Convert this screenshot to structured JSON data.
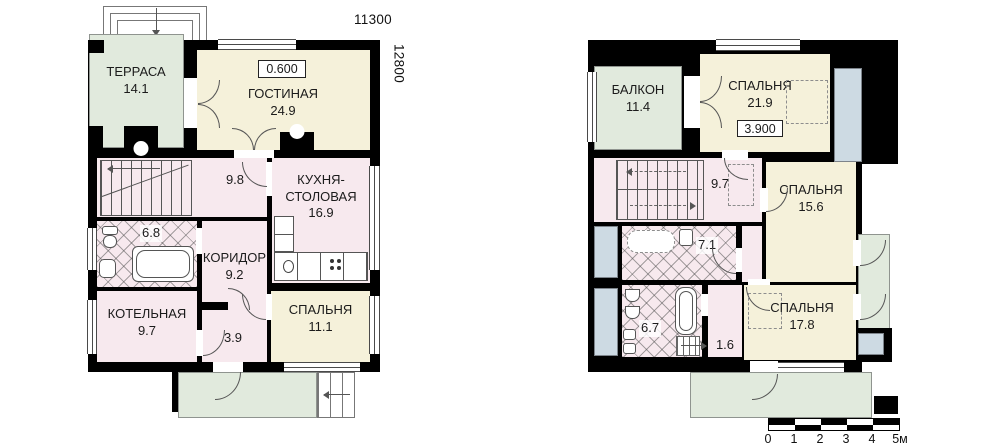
{
  "floor1": {
    "dimensions": {
      "width_mm": "11300",
      "height_mm": "12800"
    },
    "level_mark": "0.600",
    "rooms": {
      "terrace": {
        "name": "ТЕРРАСА",
        "area": "14.1"
      },
      "living": {
        "name": "ГОСТИНАЯ",
        "area": "24.9"
      },
      "hall": {
        "area": "9.8"
      },
      "kitchen": {
        "name": "КУХНЯ-СТОЛОВАЯ",
        "area": "16.9"
      },
      "bathroom": {
        "area": "6.8"
      },
      "corridor": {
        "name": "КОРИДОР",
        "area": "9.2"
      },
      "boiler": {
        "name": "КОТЕЛЬНАЯ",
        "area": "9.7"
      },
      "hall2": {
        "area": "3.9"
      },
      "bedroom": {
        "name": "СПАЛЬНЯ",
        "area": "11.1"
      }
    }
  },
  "floor2": {
    "level_mark": "3.900",
    "rooms": {
      "balcony": {
        "name": "БАЛКОН",
        "area": "11.4"
      },
      "bedroom1": {
        "name": "СПАЛЬНЯ",
        "area": "21.9"
      },
      "hall": {
        "area": "9.7"
      },
      "bedroom2": {
        "name": "СПАЛЬНЯ",
        "area": "15.6"
      },
      "bathroom1": {
        "area": "7.1"
      },
      "bathroom2": {
        "area": "6.7"
      },
      "hall2": {
        "area": "1.6"
      },
      "bedroom3": {
        "name": "СПАЛЬНЯ",
        "area": "17.8"
      }
    }
  },
  "scale_bar": {
    "unit_labels": [
      "0",
      "1",
      "2",
      "3",
      "4",
      "5м"
    ]
  },
  "colors": {
    "wall": "#000000",
    "room_living": "#f5f1da",
    "room_service": "#f7e9ee",
    "outdoor": "#e1eadd",
    "glazing": "#cddae3"
  }
}
